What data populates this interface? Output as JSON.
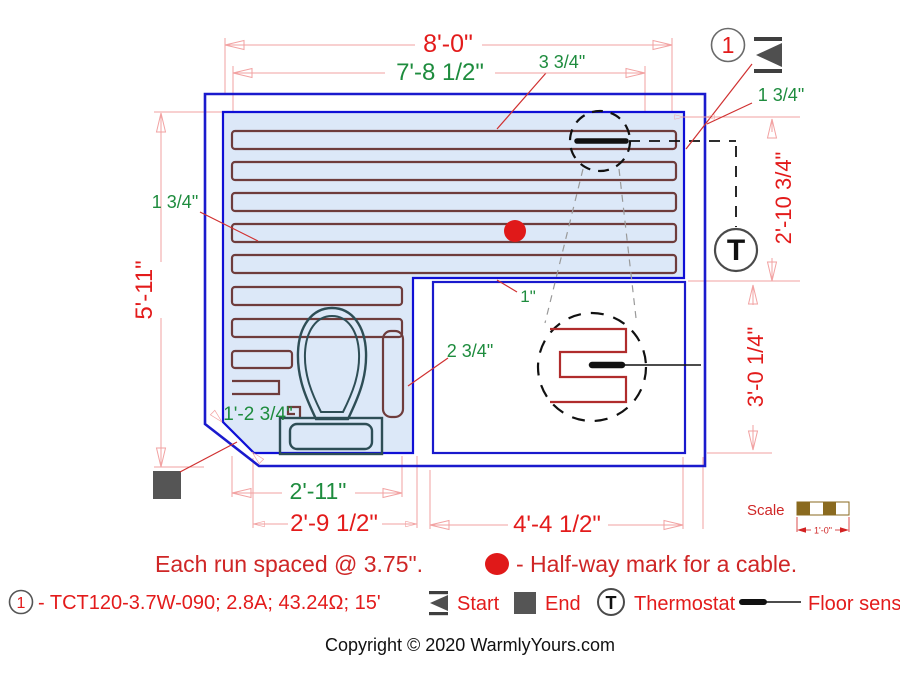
{
  "plan": {
    "dims": {
      "top_width_outer": "8'-0\"",
      "top_width_inner": "7'-8 1/2\"",
      "gap_top_first_run": "3 3/4\"",
      "gap_right_wall": "1 3/4\"",
      "left_height": "5'-11\"",
      "gap_left_wall": "1 3/4\"",
      "right_upper_height": "2'-10 3/4\"",
      "right_lower_height": "3'-0 1/4\"",
      "gap_last_run": "1\"",
      "gap_column_right": "2 3/4\"",
      "toilet_clearance": "1'-2 3/4\"",
      "bottom_column_inner": "2'-11\"",
      "bottom_column_outer": "2'-9 1/2\"",
      "bottom_right_width": "4'-4 1/2\""
    },
    "callout_number": "1",
    "thermostat_symbol": "T",
    "scale": {
      "label": "Scale",
      "unit": "1'-0\""
    }
  },
  "notes": {
    "spacing_note": "Each run spaced @ 3.75\".",
    "halfway_note": "- Half-way mark for a cable."
  },
  "legend": {
    "item_number": "1",
    "cable_spec": "- TCT120-3.7W-090; 2.8A; 43.24Ω; 15'",
    "start_label": "Start",
    "end_label": "End",
    "thermostat_symbol": "T",
    "thermostat_label": "Thermostat",
    "floor_sensor_label": "Floor sensor"
  },
  "footer": {
    "copyright": "Copyright © 2020 WarmlyYours.com"
  },
  "colors": {
    "wall_blue": "#1a1acd",
    "heated_fill": "#dce8f8",
    "cable_maroon": "#6e3c3c",
    "detail_cable_red": "#b02c2c",
    "dim_pink": "#f2a2a2",
    "dim_red": "#e31b1b",
    "dim_green": "#1e8c3e",
    "symbol_gray": "#4f4f4f",
    "scale_brown": "#8a6a1f",
    "halfway_dot_red": "#e01919"
  }
}
